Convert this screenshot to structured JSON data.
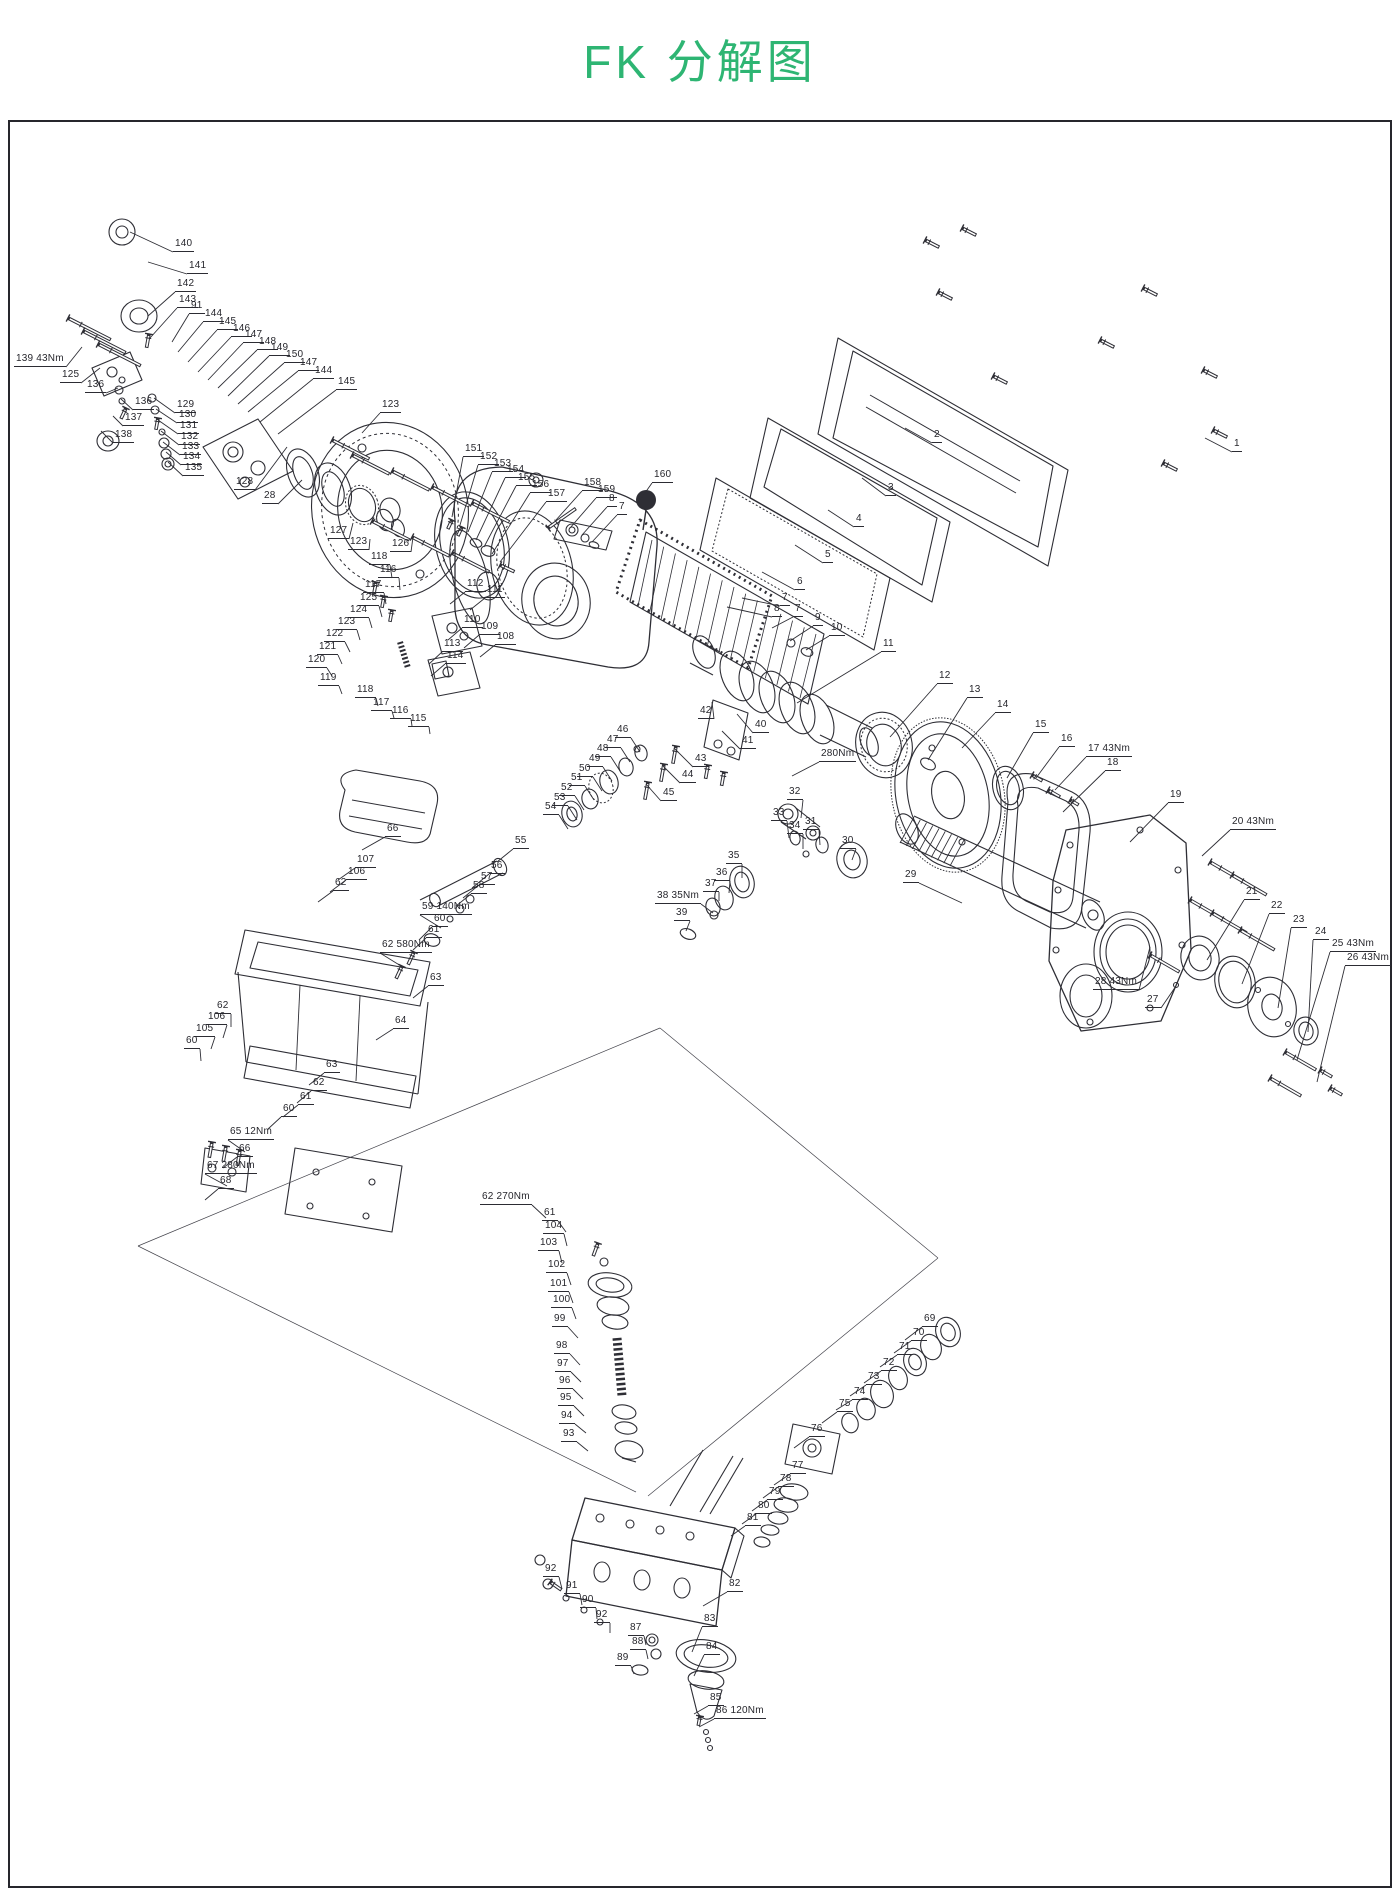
{
  "page": {
    "title": "FK 分解图",
    "accent_color": "#2eb573",
    "line_color": "#2e2e35",
    "background": "#ffffff"
  },
  "torque_notes": [
    "139 43Nm",
    "280Nm",
    "17 43Nm",
    "20 43Nm",
    "25 43Nm",
    "26 43Nm",
    "28 43Nm",
    "38 35Nm",
    "59 140Nm",
    "62 580Nm",
    "65 12Nm",
    "66",
    "67 280Nm",
    "62 270Nm",
    "86 120Nm"
  ],
  "callouts": [
    {
      "t": "140",
      "x": 173,
      "y": 252,
      "tx": 130,
      "ty": 232
    },
    {
      "t": "141",
      "x": 187,
      "y": 274,
      "tx": 148,
      "ty": 262
    },
    {
      "t": "142",
      "x": 175,
      "y": 292,
      "tx": 148,
      "ty": 316
    },
    {
      "t": "143",
      "x": 177,
      "y": 308,
      "tx": 150,
      "ty": 338
    },
    {
      "t": "91",
      "x": 189,
      "y": 314,
      "tx": 172,
      "ty": 342
    },
    {
      "t": "144",
      "x": 203,
      "y": 322,
      "tx": 178,
      "ty": 352
    },
    {
      "t": "145",
      "x": 217,
      "y": 330,
      "tx": 188,
      "ty": 362
    },
    {
      "t": "146",
      "x": 231,
      "y": 337,
      "tx": 198,
      "ty": 372
    },
    {
      "t": "147",
      "x": 243,
      "y": 343,
      "tx": 208,
      "ty": 380
    },
    {
      "t": "148",
      "x": 257,
      "y": 350,
      "tx": 218,
      "ty": 388
    },
    {
      "t": "149",
      "x": 269,
      "y": 356,
      "tx": 228,
      "ty": 396
    },
    {
      "t": "150",
      "x": 284,
      "y": 363,
      "tx": 238,
      "ty": 404
    },
    {
      "t": "147",
      "x": 298,
      "y": 371,
      "tx": 248,
      "ty": 412
    },
    {
      "t": "144",
      "x": 313,
      "y": 379,
      "tx": 260,
      "ty": 422
    },
    {
      "t": "145",
      "x": 336,
      "y": 390,
      "tx": 278,
      "ty": 434
    },
    {
      "t": "139 43Nm",
      "x": 14,
      "y": 367,
      "tx": 82,
      "ty": 347
    },
    {
      "t": "125",
      "x": 60,
      "y": 383,
      "tx": 100,
      "ty": 368
    },
    {
      "t": "136",
      "x": 85,
      "y": 393,
      "tx": 118,
      "ty": 388
    },
    {
      "t": "136",
      "x": 133,
      "y": 410,
      "tx": 121,
      "ty": 399
    },
    {
      "t": "137",
      "x": 123,
      "y": 426,
      "tx": 113,
      "ty": 416
    },
    {
      "t": "138",
      "x": 113,
      "y": 443,
      "tx": 101,
      "ty": 431
    },
    {
      "t": "129",
      "x": 175,
      "y": 413,
      "tx": 154,
      "ty": 398
    },
    {
      "t": "130",
      "x": 177,
      "y": 423,
      "tx": 156,
      "ty": 409
    },
    {
      "t": "131",
      "x": 178,
      "y": 434,
      "tx": 158,
      "ty": 420
    },
    {
      "t": "132",
      "x": 179,
      "y": 445,
      "tx": 161,
      "ty": 431
    },
    {
      "t": "133",
      "x": 180,
      "y": 455,
      "tx": 163,
      "ty": 442
    },
    {
      "t": "134",
      "x": 181,
      "y": 465,
      "tx": 166,
      "ty": 452
    },
    {
      "t": "135",
      "x": 183,
      "y": 476,
      "tx": 168,
      "ty": 462
    },
    {
      "t": "128",
      "x": 234,
      "y": 490,
      "tx": 287,
      "ty": 447
    },
    {
      "t": "28",
      "x": 262,
      "y": 504,
      "tx": 302,
      "ty": 480
    },
    {
      "t": "123",
      "x": 380,
      "y": 413,
      "tx": 362,
      "ty": 433
    },
    {
      "t": "127",
      "x": 328,
      "y": 539,
      "tx": 353,
      "ty": 523
    },
    {
      "t": "123",
      "x": 348,
      "y": 550,
      "tx": 370,
      "ty": 539
    },
    {
      "t": "126",
      "x": 390,
      "y": 552,
      "tx": 413,
      "ty": 537
    },
    {
      "t": "151",
      "x": 463,
      "y": 457,
      "tx": 452,
      "ty": 517
    },
    {
      "t": "152",
      "x": 478,
      "y": 465,
      "tx": 460,
      "ty": 525
    },
    {
      "t": "153",
      "x": 492,
      "y": 472,
      "tx": 468,
      "ty": 532
    },
    {
      "t": "154",
      "x": 505,
      "y": 478,
      "tx": 476,
      "ty": 540
    },
    {
      "t": "155",
      "x": 516,
      "y": 486,
      "tx": 484,
      "ty": 547
    },
    {
      "t": "156",
      "x": 530,
      "y": 493,
      "tx": 492,
      "ty": 554
    },
    {
      "t": "157",
      "x": 546,
      "y": 502,
      "tx": 500,
      "ty": 562
    },
    {
      "t": "158",
      "x": 582,
      "y": 491,
      "tx": 556,
      "ty": 520
    },
    {
      "t": "159",
      "x": 596,
      "y": 498,
      "tx": 570,
      "ty": 528
    },
    {
      "t": "8",
      "x": 607,
      "y": 507,
      "tx": 582,
      "ty": 535
    },
    {
      "t": "7",
      "x": 617,
      "y": 515,
      "tx": 592,
      "ty": 542
    },
    {
      "t": "160",
      "x": 652,
      "y": 483,
      "tx": 640,
      "ty": 500
    },
    {
      "t": "1",
      "x": 1232,
      "y": 452,
      "tx": 1205,
      "ty": 438
    },
    {
      "t": "2",
      "x": 932,
      "y": 443,
      "tx": 905,
      "ty": 428
    },
    {
      "t": "3",
      "x": 886,
      "y": 496,
      "tx": 862,
      "ty": 478
    },
    {
      "t": "4",
      "x": 854,
      "y": 527,
      "tx": 828,
      "ty": 510
    },
    {
      "t": "5",
      "x": 823,
      "y": 563,
      "tx": 795,
      "ty": 545
    },
    {
      "t": "6",
      "x": 795,
      "y": 590,
      "tx": 762,
      "ty": 572
    },
    {
      "t": "7",
      "x": 780,
      "y": 606,
      "tx": 742,
      "ty": 598
    },
    {
      "t": "8",
      "x": 772,
      "y": 617,
      "tx": 727,
      "ty": 607
    },
    {
      "t": "7",
      "x": 793,
      "y": 617,
      "tx": 772,
      "ty": 628
    },
    {
      "t": "9",
      "x": 813,
      "y": 626,
      "tx": 790,
      "ty": 641
    },
    {
      "t": "10",
      "x": 829,
      "y": 636,
      "tx": 806,
      "ty": 650
    },
    {
      "t": "11",
      "x": 881,
      "y": 652,
      "tx": 797,
      "ty": 703
    },
    {
      "t": "12",
      "x": 937,
      "y": 684,
      "tx": 890,
      "ty": 737
    },
    {
      "t": "13",
      "x": 967,
      "y": 698,
      "tx": 928,
      "ty": 760
    },
    {
      "t": "14",
      "x": 995,
      "y": 713,
      "tx": 962,
      "ty": 748
    },
    {
      "t": "15",
      "x": 1033,
      "y": 733,
      "tx": 1007,
      "ty": 778
    },
    {
      "t": "16",
      "x": 1059,
      "y": 747,
      "tx": 1036,
      "ty": 778
    },
    {
      "t": "17 43Nm",
      "x": 1086,
      "y": 757,
      "tx": 1055,
      "ty": 790
    },
    {
      "t": "18",
      "x": 1105,
      "y": 771,
      "tx": 1063,
      "ty": 812
    },
    {
      "t": "19",
      "x": 1168,
      "y": 803,
      "tx": 1130,
      "ty": 842
    },
    {
      "t": "20 43Nm",
      "x": 1230,
      "y": 830,
      "tx": 1202,
      "ty": 856
    },
    {
      "t": "21",
      "x": 1244,
      "y": 900,
      "tx": 1207,
      "ty": 960
    },
    {
      "t": "22",
      "x": 1269,
      "y": 914,
      "tx": 1242,
      "ty": 984
    },
    {
      "t": "23",
      "x": 1291,
      "y": 928,
      "tx": 1278,
      "ty": 1008
    },
    {
      "t": "24",
      "x": 1313,
      "y": 940,
      "tx": 1308,
      "ty": 1032
    },
    {
      "t": "25 43Nm",
      "x": 1330,
      "y": 952,
      "tx": 1297,
      "ty": 1060
    },
    {
      "t": "26 43Nm",
      "x": 1345,
      "y": 966,
      "tx": 1317,
      "ty": 1082
    },
    {
      "t": "28 43Nm",
      "x": 1093,
      "y": 990,
      "tx": 1150,
      "ty": 947
    },
    {
      "t": "27",
      "x": 1145,
      "y": 1008,
      "tx": 1176,
      "ty": 986
    },
    {
      "t": "29",
      "x": 903,
      "y": 883,
      "tx": 962,
      "ty": 903
    },
    {
      "t": "42",
      "x": 698,
      "y": 719,
      "tx": 712,
      "ty": 702
    },
    {
      "t": "40",
      "x": 753,
      "y": 733,
      "tx": 737,
      "ty": 714
    },
    {
      "t": "41",
      "x": 740,
      "y": 749,
      "tx": 722,
      "ty": 731
    },
    {
      "t": "43",
      "x": 693,
      "y": 767,
      "tx": 674,
      "ty": 748
    },
    {
      "t": "44",
      "x": 680,
      "y": 783,
      "tx": 663,
      "ty": 766
    },
    {
      "t": "45",
      "x": 661,
      "y": 801,
      "tx": 646,
      "ty": 784
    },
    {
      "t": "280Nm",
      "x": 819,
      "y": 762,
      "tx": 792,
      "ty": 776
    },
    {
      "t": "32",
      "x": 787,
      "y": 800,
      "tx": 801,
      "ty": 818
    },
    {
      "t": "33",
      "x": 771,
      "y": 821,
      "tx": 789,
      "ty": 838
    },
    {
      "t": "34",
      "x": 787,
      "y": 834,
      "tx": 803,
      "ty": 849
    },
    {
      "t": "31",
      "x": 803,
      "y": 830,
      "tx": 820,
      "ty": 845
    },
    {
      "t": "30",
      "x": 840,
      "y": 849,
      "tx": 852,
      "ty": 860
    },
    {
      "t": "35",
      "x": 726,
      "y": 864,
      "tx": 742,
      "ty": 878
    },
    {
      "t": "36",
      "x": 714,
      "y": 881,
      "tx": 729,
      "ty": 893
    },
    {
      "t": "37",
      "x": 703,
      "y": 892,
      "tx": 719,
      "ty": 901
    },
    {
      "t": "38 35Nm",
      "x": 655,
      "y": 904,
      "tx": 713,
      "ty": 913
    },
    {
      "t": "39",
      "x": 674,
      "y": 921,
      "tx": 686,
      "ty": 931
    },
    {
      "t": "46",
      "x": 615,
      "y": 738,
      "tx": 640,
      "ty": 752
    },
    {
      "t": "47",
      "x": 605,
      "y": 748,
      "tx": 630,
      "ty": 762
    },
    {
      "t": "48",
      "x": 595,
      "y": 757,
      "tx": 620,
      "ty": 771
    },
    {
      "t": "49",
      "x": 587,
      "y": 767,
      "tx": 612,
      "ty": 781
    },
    {
      "t": "50",
      "x": 577,
      "y": 777,
      "tx": 602,
      "ty": 791
    },
    {
      "t": "51",
      "x": 569,
      "y": 786,
      "tx": 594,
      "ty": 800
    },
    {
      "t": "52",
      "x": 559,
      "y": 796,
      "tx": 584,
      "ty": 810
    },
    {
      "t": "53",
      "x": 552,
      "y": 806,
      "tx": 577,
      "ty": 820
    },
    {
      "t": "54",
      "x": 543,
      "y": 815,
      "tx": 568,
      "ty": 829
    },
    {
      "t": "118",
      "x": 369,
      "y": 565,
      "tx": 392,
      "ty": 578
    },
    {
      "t": "116",
      "x": 378,
      "y": 578,
      "tx": 400,
      "ty": 590
    },
    {
      "t": "117",
      "x": 363,
      "y": 593,
      "tx": 386,
      "ty": 604
    },
    {
      "t": "125",
      "x": 358,
      "y": 606,
      "tx": 382,
      "ty": 617
    },
    {
      "t": "124",
      "x": 348,
      "y": 618,
      "tx": 372,
      "ty": 628
    },
    {
      "t": "123",
      "x": 336,
      "y": 630,
      "tx": 360,
      "ty": 640
    },
    {
      "t": "122",
      "x": 324,
      "y": 642,
      "tx": 350,
      "ty": 652
    },
    {
      "t": "121",
      "x": 317,
      "y": 655,
      "tx": 342,
      "ty": 664
    },
    {
      "t": "120",
      "x": 306,
      "y": 668,
      "tx": 332,
      "ty": 676
    },
    {
      "t": "119",
      "x": 318,
      "y": 686,
      "tx": 342,
      "ty": 694
    },
    {
      "t": "118",
      "x": 355,
      "y": 698,
      "tx": 378,
      "ty": 706
    },
    {
      "t": "117",
      "x": 371,
      "y": 711,
      "tx": 394,
      "ty": 718
    },
    {
      "t": "116",
      "x": 390,
      "y": 719,
      "tx": 412,
      "ty": 726
    },
    {
      "t": "115",
      "x": 408,
      "y": 727,
      "tx": 430,
      "ty": 734
    },
    {
      "t": "112",
      "x": 465,
      "y": 592,
      "tx": 450,
      "ty": 604
    },
    {
      "t": "111",
      "x": 485,
      "y": 598,
      "tx": 470,
      "ty": 610
    },
    {
      "t": "110",
      "x": 462,
      "y": 628,
      "tx": 448,
      "ty": 640
    },
    {
      "t": "109",
      "x": 479,
      "y": 635,
      "tx": 464,
      "ty": 648
    },
    {
      "t": "108",
      "x": 495,
      "y": 645,
      "tx": 480,
      "ty": 657
    },
    {
      "t": "113",
      "x": 442,
      "y": 652,
      "tx": 429,
      "ty": 664
    },
    {
      "t": "114",
      "x": 445,
      "y": 664,
      "tx": 431,
      "ty": 676
    },
    {
      "t": "66",
      "x": 385,
      "y": 837,
      "tx": 362,
      "ty": 850
    },
    {
      "t": "107",
      "x": 355,
      "y": 868,
      "tx": 338,
      "ty": 880
    },
    {
      "t": "106",
      "x": 346,
      "y": 880,
      "tx": 330,
      "ty": 892
    },
    {
      "t": "62",
      "x": 333,
      "y": 891,
      "tx": 318,
      "ty": 902
    },
    {
      "t": "55",
      "x": 513,
      "y": 849,
      "tx": 497,
      "ty": 862
    },
    {
      "t": "56",
      "x": 489,
      "y": 874,
      "tx": 472,
      "ty": 888
    },
    {
      "t": "57",
      "x": 479,
      "y": 885,
      "tx": 463,
      "ty": 898
    },
    {
      "t": "58",
      "x": 471,
      "y": 894,
      "tx": 456,
      "ty": 906
    },
    {
      "t": "59 140Nm",
      "x": 420,
      "y": 915,
      "tx": 441,
      "ty": 928
    },
    {
      "t": "60",
      "x": 432,
      "y": 927,
      "tx": 419,
      "ty": 940
    },
    {
      "t": "61",
      "x": 426,
      "y": 938,
      "tx": 413,
      "ty": 950
    },
    {
      "t": "62 580Nm",
      "x": 380,
      "y": 953,
      "tx": 401,
      "ty": 966
    },
    {
      "t": "63",
      "x": 428,
      "y": 986,
      "tx": 413,
      "ty": 998
    },
    {
      "t": "64",
      "x": 393,
      "y": 1029,
      "tx": 376,
      "ty": 1040
    },
    {
      "t": "62",
      "x": 215,
      "y": 1014,
      "tx": 231,
      "ty": 1027
    },
    {
      "t": "106",
      "x": 206,
      "y": 1025,
      "tx": 223,
      "ty": 1038
    },
    {
      "t": "105",
      "x": 194,
      "y": 1037,
      "tx": 211,
      "ty": 1049
    },
    {
      "t": "60",
      "x": 184,
      "y": 1049,
      "tx": 201,
      "ty": 1061
    },
    {
      "t": "63",
      "x": 324,
      "y": 1073,
      "tx": 309,
      "ty": 1085
    },
    {
      "t": "62",
      "x": 311,
      "y": 1091,
      "tx": 297,
      "ty": 1103
    },
    {
      "t": "61",
      "x": 298,
      "y": 1105,
      "tx": 283,
      "ty": 1117
    },
    {
      "t": "60",
      "x": 281,
      "y": 1117,
      "tx": 268,
      "ty": 1129
    },
    {
      "t": "65 12Nm",
      "x": 228,
      "y": 1140,
      "tx": 245,
      "ty": 1152
    },
    {
      "t": "66",
      "x": 237,
      "y": 1157,
      "tx": 223,
      "ty": 1168
    },
    {
      "t": "67 280Nm",
      "x": 205,
      "y": 1174,
      "tx": 227,
      "ty": 1186
    },
    {
      "t": "68",
      "x": 218,
      "y": 1189,
      "tx": 205,
      "ty": 1200
    },
    {
      "t": "62 270Nm",
      "x": 480,
      "y": 1205,
      "tx": 546,
      "ty": 1218
    },
    {
      "t": "61",
      "x": 542,
      "y": 1221,
      "tx": 566,
      "ty": 1232
    },
    {
      "t": "104",
      "x": 543,
      "y": 1234,
      "tx": 567,
      "ty": 1246
    },
    {
      "t": "103",
      "x": 538,
      "y": 1251,
      "tx": 562,
      "ty": 1263
    },
    {
      "t": "102",
      "x": 546,
      "y": 1273,
      "tx": 571,
      "ty": 1285
    },
    {
      "t": "101",
      "x": 548,
      "y": 1292,
      "tx": 573,
      "ty": 1303
    },
    {
      "t": "100",
      "x": 551,
      "y": 1308,
      "tx": 576,
      "ty": 1319
    },
    {
      "t": "99",
      "x": 552,
      "y": 1327,
      "tx": 578,
      "ty": 1338
    },
    {
      "t": "98",
      "x": 554,
      "y": 1354,
      "tx": 580,
      "ty": 1365
    },
    {
      "t": "97",
      "x": 555,
      "y": 1372,
      "tx": 581,
      "ty": 1382
    },
    {
      "t": "96",
      "x": 557,
      "y": 1389,
      "tx": 583,
      "ty": 1399
    },
    {
      "t": "95",
      "x": 558,
      "y": 1406,
      "tx": 584,
      "ty": 1416
    },
    {
      "t": "94",
      "x": 559,
      "y": 1424,
      "tx": 586,
      "ty": 1433
    },
    {
      "t": "93",
      "x": 561,
      "y": 1442,
      "tx": 588,
      "ty": 1451
    },
    {
      "t": "69",
      "x": 922,
      "y": 1327,
      "tx": 905,
      "ty": 1340
    },
    {
      "t": "70",
      "x": 911,
      "y": 1341,
      "tx": 894,
      "ty": 1353
    },
    {
      "t": "71",
      "x": 897,
      "y": 1355,
      "tx": 880,
      "ty": 1367
    },
    {
      "t": "72",
      "x": 881,
      "y": 1371,
      "tx": 864,
      "ty": 1383
    },
    {
      "t": "73",
      "x": 866,
      "y": 1385,
      "tx": 850,
      "ty": 1396
    },
    {
      "t": "74",
      "x": 852,
      "y": 1400,
      "tx": 836,
      "ty": 1410
    },
    {
      "t": "75",
      "x": 837,
      "y": 1412,
      "tx": 822,
      "ty": 1423
    },
    {
      "t": "76",
      "x": 809,
      "y": 1437,
      "tx": 794,
      "ty": 1448
    },
    {
      "t": "77",
      "x": 790,
      "y": 1474,
      "tx": 774,
      "ty": 1485
    },
    {
      "t": "78",
      "x": 778,
      "y": 1487,
      "tx": 763,
      "ty": 1498
    },
    {
      "t": "79",
      "x": 767,
      "y": 1500,
      "tx": 752,
      "ty": 1511
    },
    {
      "t": "80",
      "x": 756,
      "y": 1514,
      "tx": 742,
      "ty": 1524
    },
    {
      "t": "81",
      "x": 745,
      "y": 1526,
      "tx": 731,
      "ty": 1536
    },
    {
      "t": "92",
      "x": 543,
      "y": 1577,
      "tx": 562,
      "ty": 1589
    },
    {
      "t": "91",
      "x": 564,
      "y": 1594,
      "tx": 582,
      "ty": 1605
    },
    {
      "t": "90",
      "x": 580,
      "y": 1608,
      "tx": 597,
      "ty": 1619
    },
    {
      "t": "92",
      "x": 594,
      "y": 1623,
      "tx": 610,
      "ty": 1633
    },
    {
      "t": "82",
      "x": 727,
      "y": 1592,
      "tx": 703,
      "ty": 1606
    },
    {
      "t": "83",
      "x": 702,
      "y": 1627,
      "tx": 692,
      "ty": 1652
    },
    {
      "t": "84",
      "x": 704,
      "y": 1655,
      "tx": 694,
      "ty": 1676
    },
    {
      "t": "87",
      "x": 628,
      "y": 1636,
      "tx": 646,
      "ty": 1645
    },
    {
      "t": "88",
      "x": 630,
      "y": 1650,
      "tx": 648,
      "ty": 1659
    },
    {
      "t": "89",
      "x": 615,
      "y": 1666,
      "tx": 634,
      "ty": 1674
    },
    {
      "t": "85",
      "x": 708,
      "y": 1706,
      "tx": 694,
      "ty": 1714
    },
    {
      "t": "86 120Nm",
      "x": 714,
      "y": 1719,
      "tx": 699,
      "ty": 1727
    }
  ]
}
